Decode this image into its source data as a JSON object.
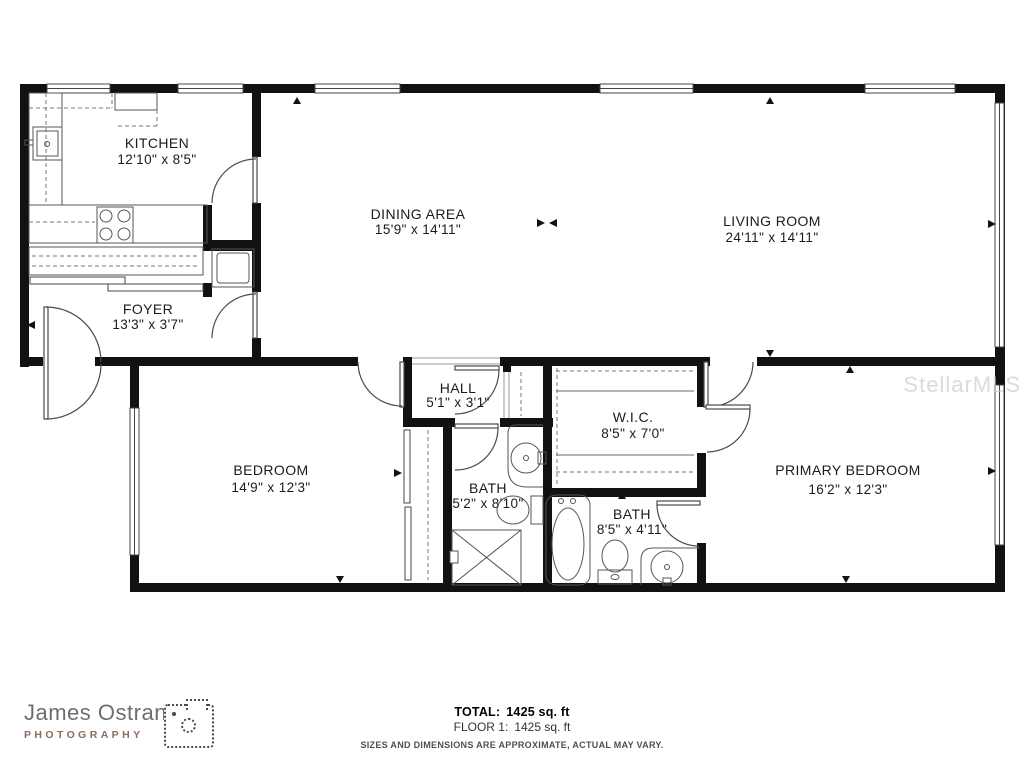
{
  "plan": {
    "watermark": "StellarMLS",
    "rooms": {
      "kitchen": {
        "name": "KITCHEN",
        "dims": "12'10\" x 8'5\""
      },
      "dining": {
        "name": "DINING AREA",
        "dims": "15'9\" x 14'11\""
      },
      "living": {
        "name": "LIVING ROOM",
        "dims": "24'11\" x 14'11\""
      },
      "foyer": {
        "name": "FOYER",
        "dims": "13'3\" x 3'7\""
      },
      "hall": {
        "name": "HALL",
        "dims": "5'1\" x 3'1\""
      },
      "wic": {
        "name": "W.I.C.",
        "dims": "8'5\" x 7'0\""
      },
      "bedroom": {
        "name": "BEDROOM",
        "dims": "14'9\" x 12'3\""
      },
      "bath_hall": {
        "name": "BATH",
        "dims": "5'2\" x 8'10\""
      },
      "bath_primary": {
        "name": "BATH",
        "dims": "8'5\" x 4'11\""
      },
      "primary_bedroom": {
        "name": "PRIMARY BEDROOM",
        "dims": "16'2\" x 12'3\""
      }
    }
  },
  "footer": {
    "brand_name": "James Ostrand",
    "brand_subtitle": "PHOTOGRAPHY",
    "total_label": "TOTAL:",
    "total_value": "1425 sq. ft",
    "floor_label": "FLOOR 1:",
    "floor_value": "1425 sq. ft",
    "disclaimer": "SIZES AND DIMENSIONS ARE APPROXIMATE, ACTUAL MAY VARY."
  },
  "colors": {
    "wall": "#111111",
    "thin_line": "#555555",
    "dash_line": "#777777",
    "brand_gray": "#6e6e6e",
    "brand_brown": "#8a6d5f",
    "watermark_gray": "#c6c6c6"
  }
}
